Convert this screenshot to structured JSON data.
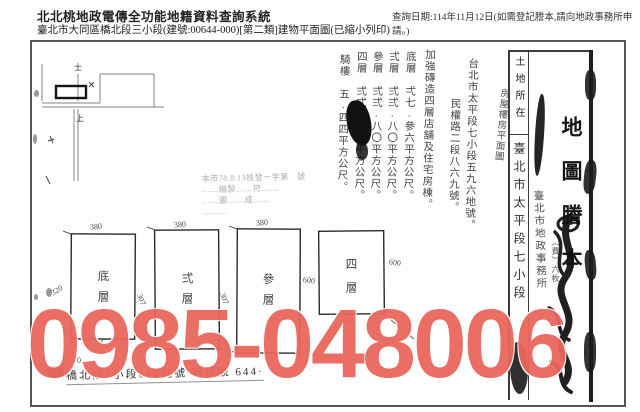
{
  "header": {
    "system_title": "北北桃地政電傳全功能地籍資料查詢系統",
    "query_date": "查詢日期:114年11月12日(如需登記謄本,請向地政事務所申請。)",
    "document_subtitle": "臺北市大同區橋北段三小段(建號:00644-000)[第二類]建物平面圖(已縮小列印)"
  },
  "watermark": {
    "text": "0985-048006",
    "color": "#ea675c"
  },
  "notes": {
    "columns": [
      {
        "text": "房屋樓房平面圖"
      },
      {
        "text": "台北市太平段七小段五九六地號。"
      },
      {
        "text": "民權路二段八六九號。"
      },
      {
        "text": "加強磚造四層店舖及住宅房棟。"
      },
      {
        "text": "底層　弌七.參六平方公尺。"
      },
      {
        "text": "弍層　弍弍.八〇平方公尺。"
      },
      {
        "text": "參層　弍弍.八〇平方公尺。"
      },
      {
        "text": "四層　弍弍.八〇平方公尺。"
      },
      {
        "text": "騎樓　五.四四平方公尺。"
      }
    ]
  },
  "faint_stamp": {
    "lines": [
      "本市78.8.13核發一字第　號",
      "……縮製……符……",
      "……圖……成……",
      "………"
    ]
  },
  "plan": {
    "floors": [
      {
        "name": "底層",
        "top_dim": "380"
      },
      {
        "name": "弍層",
        "top_dim": "380"
      },
      {
        "name": "參層",
        "top_dim": "380"
      },
      {
        "name": "四層",
        "bottom_dim": "380"
      }
    ],
    "left_dim": "320",
    "gap_dim_1": "307",
    "gap_dim_2": "307",
    "right_dim_1": "600",
    "right_dim_2": "600",
    "partial_dim": "270",
    "partial_note": "6.7"
  },
  "sketch": {
    "mark_top": "士",
    "mark_bottom": "上"
  },
  "bottom_line": {
    "text": "橋北段3小段648地號 新建號 644·"
  },
  "strip": {
    "land_location_label": "土地所在",
    "land_location_value": "臺北市太平段七小段",
    "title": "地圖謄本",
    "fee_note": "（費）六枚",
    "office_stamp": "臺北市地政事務所"
  }
}
